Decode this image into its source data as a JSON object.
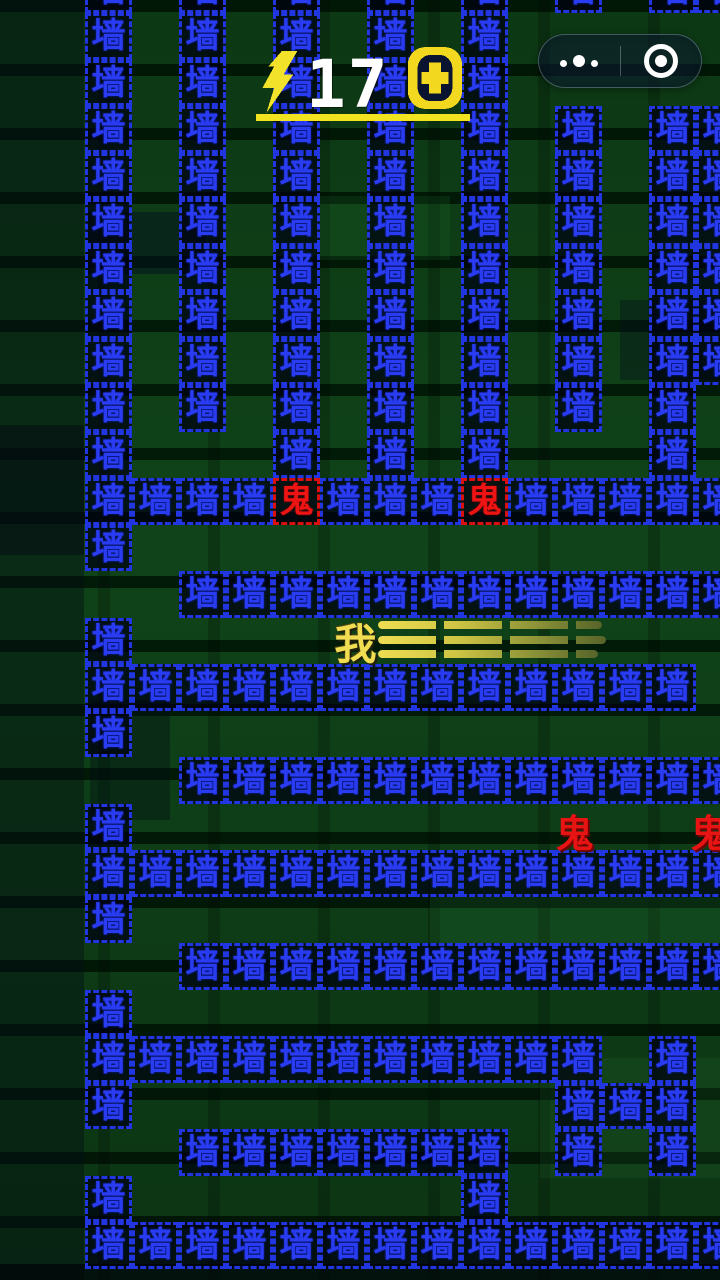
{
  "hud": {
    "score": "17",
    "lightning_icon": "lightning-bolt",
    "coin_icon": "coin-plus",
    "accent_yellow": "#f2e320",
    "score_color": "#ffffff"
  },
  "capsule": {
    "menu_icon": "more-dots",
    "home_icon": "target-circle"
  },
  "game": {
    "wall_char": "墙",
    "ghost_char": "鬼",
    "player_char": "我"
  },
  "colors": {
    "wall_text": "#2a3cf2",
    "wall_border": "#2136e0",
    "ghost_red": "#e81414",
    "player_yellow": "#f0dd52",
    "background_green": "#0b3d15"
  },
  "maze": {
    "origin_x": 85,
    "origin_y": 13,
    "cell_w": 47,
    "cell_h": 46.5,
    "columns": [
      {
        "c": 0,
        "r0": -1,
        "r1": 9
      },
      {
        "c": 2,
        "r0": -1,
        "r1": 8
      },
      {
        "c": 4,
        "r0": -1,
        "r1": 9
      },
      {
        "c": 6,
        "r0": -1,
        "r1": 9
      },
      {
        "c": 8,
        "r0": -1,
        "r1": 9
      },
      {
        "c": 10,
        "r0": -1,
        "r1": -1
      },
      {
        "c": 10,
        "r0": 2,
        "r1": 8
      },
      {
        "c": 12,
        "r0": -1,
        "r1": -1
      },
      {
        "c": 12,
        "r0": 2,
        "r1": 9
      },
      {
        "c": 13,
        "r0": -1,
        "r1": -1
      },
      {
        "c": 13,
        "r0": 2,
        "r1": 7
      }
    ],
    "rows": [
      {
        "r": 10,
        "c0": 0,
        "c1": 13
      },
      {
        "r": 11,
        "c0": 0,
        "c1": 0
      },
      {
        "r": 12,
        "c0": 2,
        "c1": 13
      },
      {
        "r": 13,
        "c0": 0,
        "c1": 0
      },
      {
        "r": 14,
        "c0": 0,
        "c1": 12
      },
      {
        "r": 15,
        "c0": 0,
        "c1": 0
      },
      {
        "r": 16,
        "c0": 2,
        "c1": 13
      },
      {
        "r": 17,
        "c0": 0,
        "c1": 0
      },
      {
        "r": 18,
        "c0": 0,
        "c1": 13
      },
      {
        "r": 19,
        "c0": 0,
        "c1": 0
      },
      {
        "r": 20,
        "c0": 2,
        "c1": 13
      },
      {
        "r": 21,
        "c0": 0,
        "c1": 0
      },
      {
        "r": 22,
        "c0": 0,
        "c1": 10
      },
      {
        "r": 22,
        "c0": 12,
        "c1": 12
      },
      {
        "r": 23,
        "c0": 0,
        "c1": 0
      },
      {
        "r": 23,
        "c0": 10,
        "c1": 12
      },
      {
        "r": 24,
        "c0": 2,
        "c1": 8
      },
      {
        "r": 24,
        "c0": 10,
        "c1": 10
      },
      {
        "r": 24,
        "c0": 12,
        "c1": 12
      },
      {
        "r": 25,
        "c0": 0,
        "c1": 0
      },
      {
        "r": 25,
        "c0": 8,
        "c1": 8
      },
      {
        "r": 26,
        "c0": 0,
        "c1": 13
      }
    ],
    "wall_ghosts": [
      {
        "r": 10,
        "c": 4
      },
      {
        "r": 10,
        "c": 8
      }
    ],
    "free_ghosts": [
      {
        "x": 551,
        "y": 803
      },
      {
        "x": 686,
        "y": 803
      }
    ],
    "player": {
      "x": 332,
      "y": 611
    },
    "dash_lines": [
      {
        "x": 378,
        "y": 621,
        "w": 224
      },
      {
        "x": 378,
        "y": 636,
        "w": 228
      },
      {
        "x": 378,
        "y": 650,
        "w": 220
      }
    ]
  }
}
